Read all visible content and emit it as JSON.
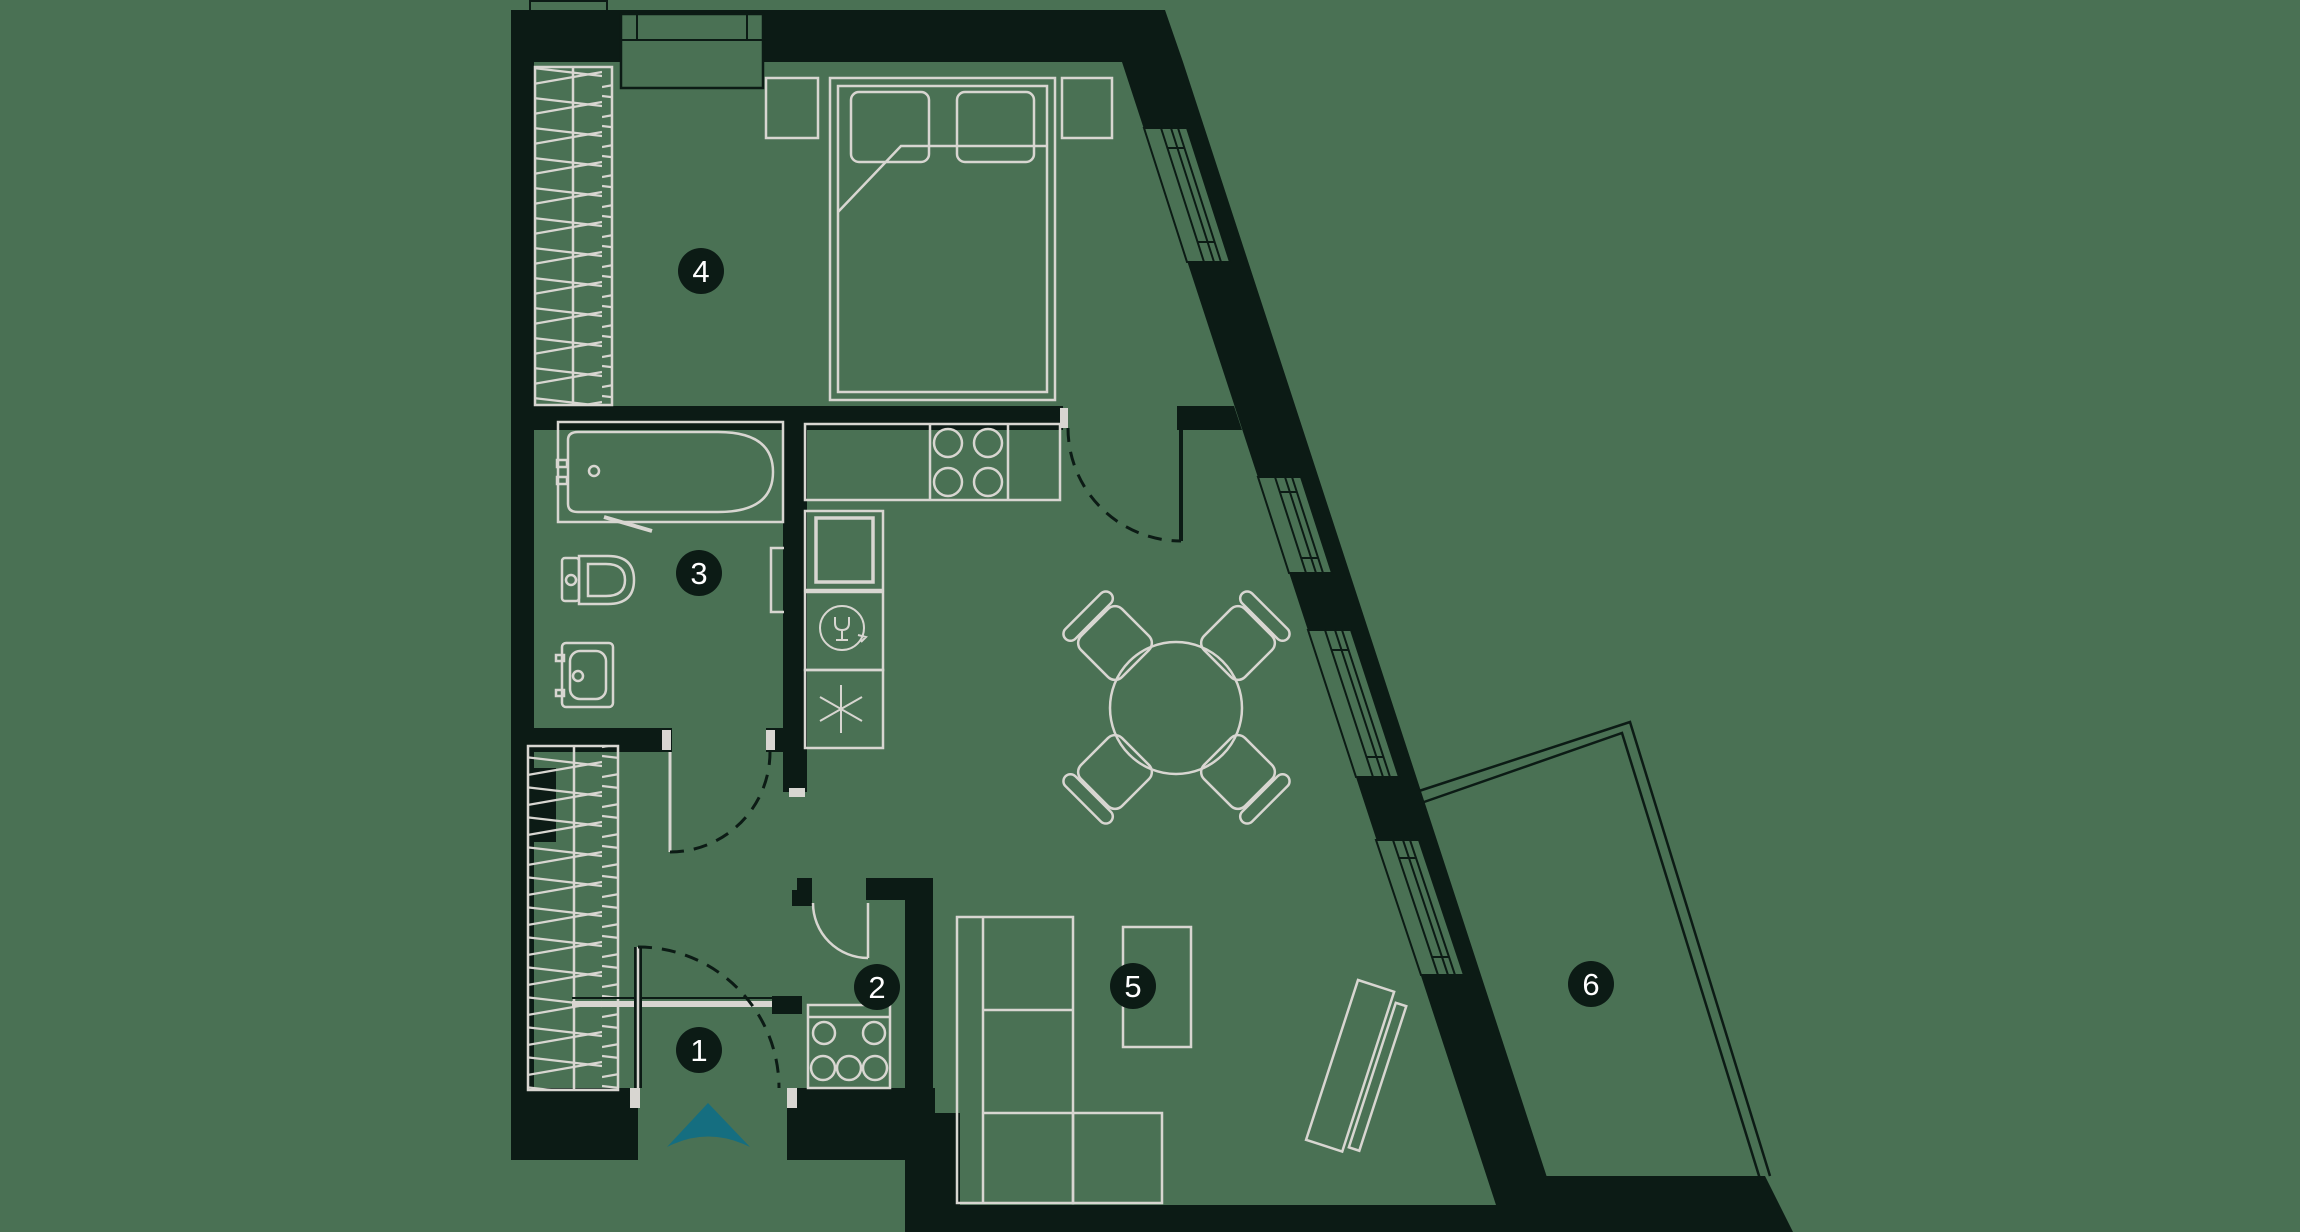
{
  "plan": {
    "room_markers": [
      {
        "number": "1"
      },
      {
        "number": "2"
      },
      {
        "number": "3"
      },
      {
        "number": "4"
      },
      {
        "number": "5"
      },
      {
        "number": "6"
      }
    ],
    "colors": {
      "background": "#4a7154",
      "wall": "#0c1b15",
      "furniture_line": "#d8d6d1",
      "entrance_arrow": "#156e80",
      "badge_text": "#ffffff"
    },
    "icons": {
      "entrance": "entrance-arrow-icon",
      "dishwasher": "wine-glass-cycle-icon",
      "fridge": "snowflake-asterisk-icon",
      "stove": "four-burner-icon",
      "wardrobe": "hatch-pattern"
    }
  }
}
